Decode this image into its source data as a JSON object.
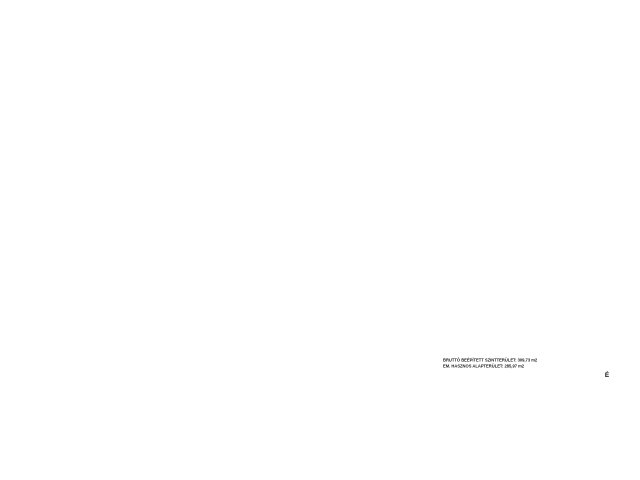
{
  "drawing": {
    "summary_line1": "BRUTTÓ BEÉPÍTETT SZINTTERÜLET: 309,73 m2",
    "summary_line2": "EM. HASZNOS ALAPTERÜLET: 285,97 m2",
    "north_label": "É"
  },
  "grid": {
    "top_labels": [
      "1",
      "2",
      "3",
      "4",
      "5",
      "6",
      "7",
      "8",
      "9",
      "10",
      "11"
    ],
    "left_labels": [
      "A",
      "B"
    ],
    "section_label": "B",
    "left_lower_label": "C",
    "right_labels": [
      "C",
      "D",
      "E",
      "F",
      "G"
    ],
    "bottom_labels": [
      "VI",
      "V",
      "IV",
      "III",
      "II",
      "I"
    ]
  },
  "colors": {
    "dim_blue": "#3b6fc4",
    "guide_blue": "#9fc3e8",
    "grid_magenta": "#dd7ad2",
    "red": "#d23b2f",
    "soft_red": "#ef8f72",
    "wall_brown": "#b15a20",
    "wall_gray": "#555555",
    "column_fill": "#ded7e4"
  },
  "dims": {
    "overall_top": "56,80",
    "bay": "5,68",
    "sub": [
      "1,35",
      "1,88"
    ],
    "pair": "90",
    "left_seg": "1,35",
    "left_overall": "17,19",
    "right_side": [
      "4,05",
      "13,14"
    ],
    "guide_val": "8,08",
    "bottom_r1": [
      "1,38",
      "8,03",
      "4,35",
      "5,36",
      "1,27"
    ],
    "bottom_r2": [
      "10,42",
      "6,63"
    ],
    "bottom_r3": [
      "13,03",
      "16,95"
    ],
    "right_lower_seg": "1,50",
    "left_lower": [
      "5,50",
      "5,25",
      "4,70"
    ],
    "inplan": [
      "7,58",
      "3,50",
      "2,26",
      "5,75",
      "1,86",
      "4,50",
      "3,27",
      "2,90",
      "5,03",
      "1,35"
    ]
  },
  "markers": {
    "upper": "+4,05",
    "lower": "+3,06"
  },
  "annotations": {
    "red_note": [
      "napelemek elhelyezése a",
      "lapostetőn, tartószerkezettel",
      "(külön terv szerint)"
    ],
    "diag_label": "acél szélrács merevítés",
    "diag_label2": "részletterv szerint",
    "roof_label": "LAPOSTETŐ",
    "red_rooms": [
      {
        "x": 184,
        "y": 250,
        "lines": [
          "2,80 m bm",
          "álmennyezet",
          "szőnyeg burkolat"
        ]
      },
      {
        "x": 233,
        "y": 299,
        "lines": [
          "7,65 m2",
          "greslap"
        ]
      },
      {
        "x": 263,
        "y": 348,
        "lines": [
          "2,80 m bm",
          "álmennyezet"
        ]
      }
    ]
  },
  "rooms": [
    {
      "name": "TÁRGYALÓ",
      "area": "27,50 m2",
      "x": 161,
      "y": 252
    },
    {
      "name": "IRODA 2",
      "area": "22,04 m2",
      "x": 158,
      "y": 304
    },
    {
      "name": "LÉPCSŐHÁZ",
      "area": "",
      "x": 222,
      "y": 268
    },
    {
      "name": "TÁRGYALÓ 2",
      "area": "19,21 m2",
      "x": 222,
      "y": 287
    },
    {
      "name": "NŐI WC",
      "area": "",
      "x": 256,
      "y": 247
    },
    {
      "name": "FFI WC",
      "area": "",
      "x": 272,
      "y": 247
    },
    {
      "name": "TEAKONYHA",
      "area": "",
      "x": 306,
      "y": 251
    },
    {
      "name": "KÖZLEKEDŐ",
      "area": "",
      "x": 262,
      "y": 331
    },
    {
      "name": "IRODA 5",
      "area": "16,42 m2",
      "x": 307,
      "y": 297
    },
    {
      "name": "IRODA 1",
      "area": "20,12 m2",
      "x": 163,
      "y": 362
    },
    {
      "name": "IRODA 3",
      "area": "17,95 m2",
      "x": 220,
      "y": 364
    },
    {
      "name": "IRODA 4",
      "area": "21,70 m2",
      "x": 267,
      "y": 364
    },
    {
      "name": "RAKTÁR",
      "area": "",
      "x": 312,
      "y": 366
    }
  ]
}
